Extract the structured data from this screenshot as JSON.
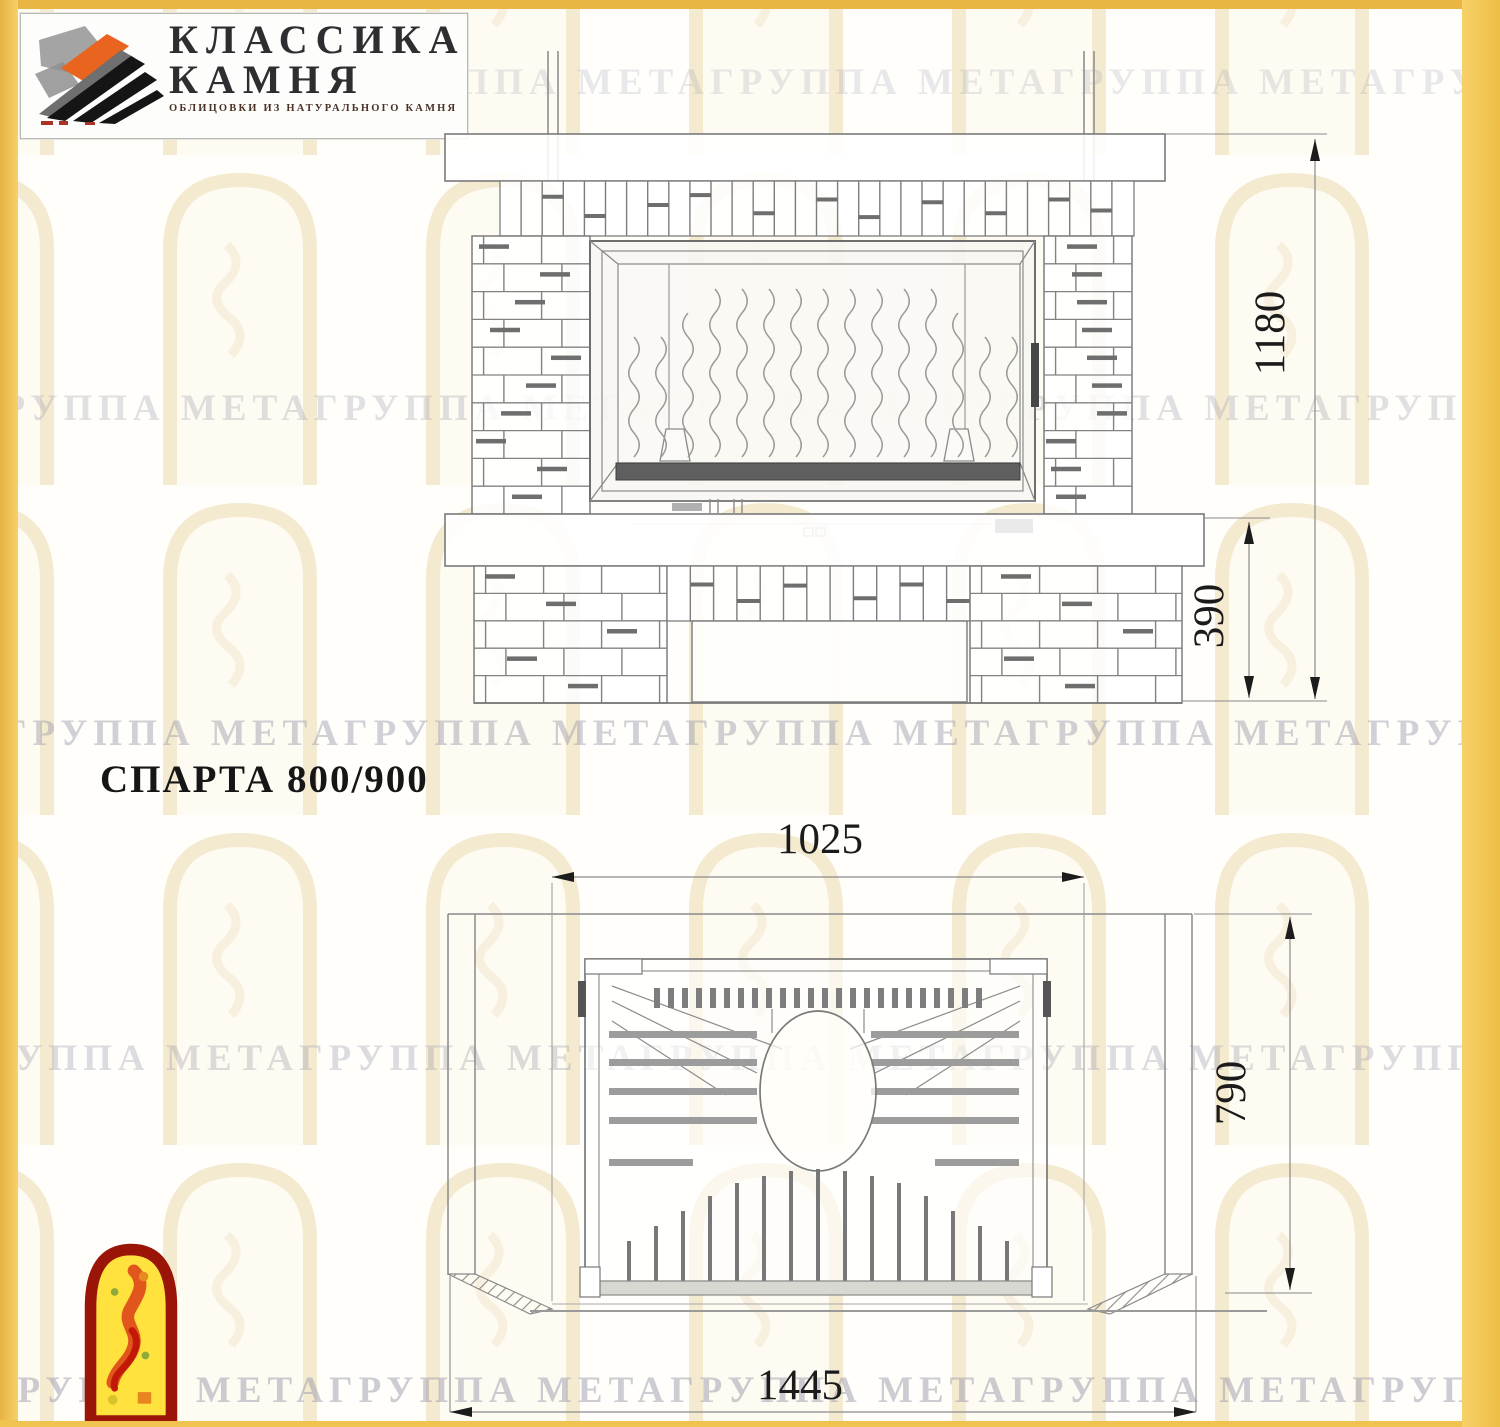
{
  "logo": {
    "line1": "КЛАССИКА",
    "line2": "КАМНЯ",
    "caption": "ОБЛИЦОВКИ ИЗ НАТУРАЛЬНОГО КАМНЯ"
  },
  "title": "СПАРТА 800/900",
  "watermark": {
    "text": "ГРУППА МЕТАГРУППА МЕТАГРУППА МЕТАГРУППА МЕТАГРУППА МЕТАГРУППА МЕТА"
  },
  "dimensions": {
    "front_view": {
      "total_height_mm": "1180",
      "base_height_mm": "390"
    },
    "top_view": {
      "opening_width_mm": "1025",
      "depth_mm": "790",
      "total_width_mm": "1445"
    }
  },
  "colors": {
    "border_yellow": "#f0c351",
    "line_gray": "#8a8a8a",
    "accent_orange": "#e8641f",
    "icon_red": "#9b1408",
    "icon_yellow": "#ffe23d"
  }
}
